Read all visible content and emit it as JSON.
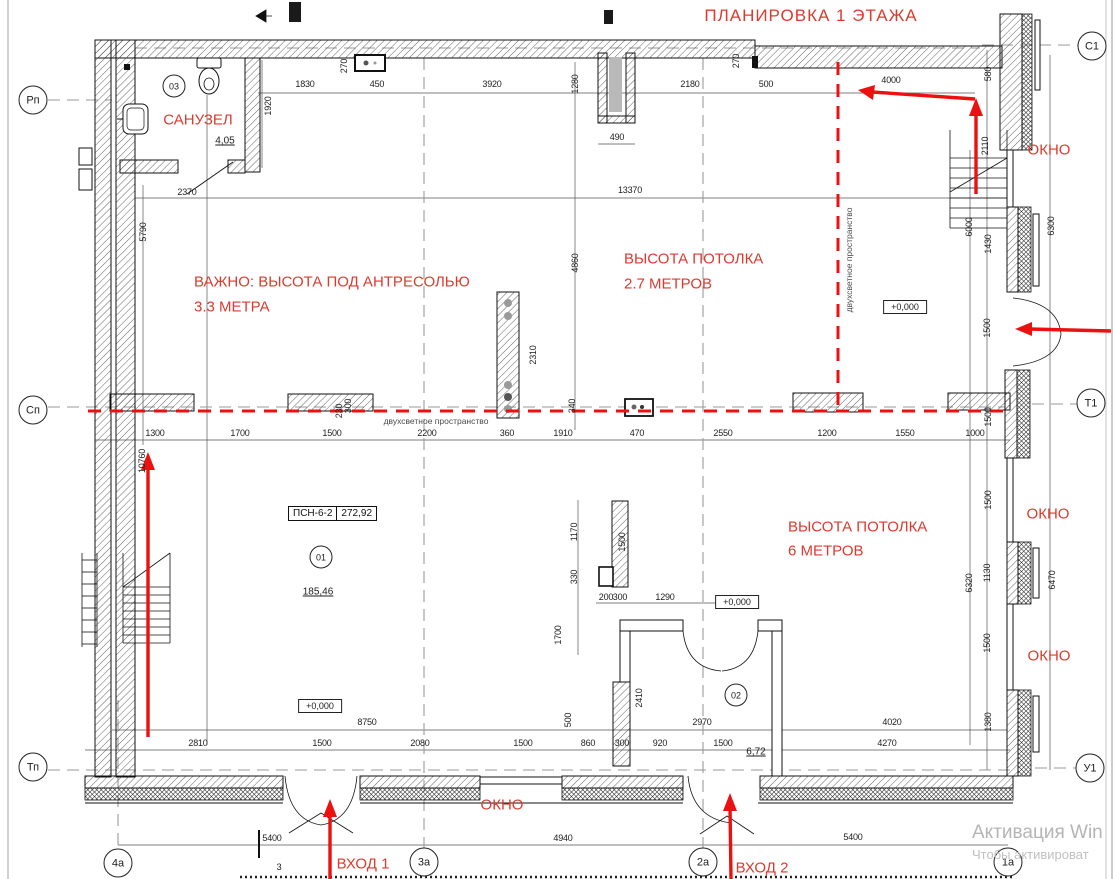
{
  "title": "ПЛАНИРОВКА 1 ЭТАЖА",
  "colors": {
    "annotation_red": "#dd3a2e",
    "arrow_red": "#ec1010",
    "drawing_black": "#111111",
    "axis_gray": "#9a9a9a",
    "watermark_gray": "#b5b5b5"
  },
  "axis_markers": [
    {
      "text": "Рп",
      "x": 33,
      "y": 100
    },
    {
      "text": "Сп",
      "x": 33,
      "y": 410
    },
    {
      "text": "Тп",
      "x": 33,
      "y": 767
    },
    {
      "text": "С1",
      "x": 1092,
      "y": 46
    },
    {
      "text": "Т1",
      "x": 1091,
      "y": 403
    },
    {
      "text": "У1",
      "x": 1090,
      "y": 768
    },
    {
      "text": "4а",
      "x": 118,
      "y": 863
    },
    {
      "text": "3а",
      "x": 424,
      "y": 862
    },
    {
      "text": "2а",
      "x": 703,
      "y": 862
    },
    {
      "text": "1а",
      "x": 1008,
      "y": 862
    }
  ],
  "red_annotations": [
    {
      "text": "САНУЗЕЛ",
      "x": 198,
      "y": 120
    },
    {
      "text": "ВАЖНО: ВЫСОТА ПОД АНТРЕСОЛЬЮ",
      "x": 194,
      "y": 282,
      "anchor": "left"
    },
    {
      "text": "3.3 МЕТРА",
      "x": 194,
      "y": 307,
      "anchor": "left"
    },
    {
      "text": "ВЫСОТА ПОТОЛКА",
      "x": 624,
      "y": 259,
      "anchor": "left"
    },
    {
      "text": "2.7 МЕТРОВ",
      "x": 624,
      "y": 284,
      "anchor": "left"
    },
    {
      "text": "ВЫСОТА ПОТОЛКА",
      "x": 788,
      "y": 527,
      "anchor": "left"
    },
    {
      "text": "6 МЕТРОВ",
      "x": 788,
      "y": 551,
      "anchor": "left"
    },
    {
      "text": "ОКНО",
      "x": 1049,
      "y": 150
    },
    {
      "text": "ОКНО",
      "x": 1048,
      "y": 514
    },
    {
      "text": "ОКНО",
      "x": 1049,
      "y": 656
    },
    {
      "text": "ОКНО",
      "x": 502,
      "y": 805
    },
    {
      "text": "ВХОД 1",
      "x": 363,
      "y": 864
    },
    {
      "text": "ВХОД 2",
      "x": 762,
      "y": 868
    }
  ],
  "dimensions": [
    {
      "text": "1830",
      "x": 305,
      "y": 84
    },
    {
      "text": "450",
      "x": 377,
      "y": 84
    },
    {
      "text": "270",
      "x": 344,
      "y": 66,
      "rot": true
    },
    {
      "text": "3920",
      "x": 492,
      "y": 84
    },
    {
      "text": "1280",
      "x": 575,
      "y": 84,
      "rot": true
    },
    {
      "text": "2180",
      "x": 690,
      "y": 84
    },
    {
      "text": "500",
      "x": 766,
      "y": 84
    },
    {
      "text": "270",
      "x": 736,
      "y": 61,
      "rot": true
    },
    {
      "text": "4000",
      "x": 891,
      "y": 80
    },
    {
      "text": "580",
      "x": 988,
      "y": 74,
      "rot": true
    },
    {
      "text": "1920",
      "x": 268,
      "y": 106,
      "rot": true
    },
    {
      "text": "490",
      "x": 617,
      "y": 137
    },
    {
      "text": "2370",
      "x": 187,
      "y": 192
    },
    {
      "text": "13370",
      "x": 630,
      "y": 190
    },
    {
      "text": "5790",
      "x": 143,
      "y": 232,
      "rot": true
    },
    {
      "text": "4860",
      "x": 575,
      "y": 263,
      "rot": true
    },
    {
      "text": "2310",
      "x": 533,
      "y": 355,
      "rot": true
    },
    {
      "text": "340",
      "x": 572,
      "y": 406,
      "rot": true
    },
    {
      "text": "2110",
      "x": 985,
      "y": 146,
      "rot": true
    },
    {
      "text": "6000",
      "x": 969,
      "y": 227,
      "rot": true
    },
    {
      "text": "1430",
      "x": 988,
      "y": 244,
      "rot": true
    },
    {
      "text": "6300",
      "x": 1051,
      "y": 226,
      "rot": true
    },
    {
      "text": "1500",
      "x": 987,
      "y": 328,
      "rot": true
    },
    {
      "text": "1300",
      "x": 155,
      "y": 433
    },
    {
      "text": "1700",
      "x": 240,
      "y": 433
    },
    {
      "text": "1500",
      "x": 332,
      "y": 433
    },
    {
      "text": "2200",
      "x": 427,
      "y": 433
    },
    {
      "text": "360",
      "x": 507,
      "y": 433
    },
    {
      "text": "1910",
      "x": 563,
      "y": 433
    },
    {
      "text": "470",
      "x": 637,
      "y": 433
    },
    {
      "text": "2550",
      "x": 723,
      "y": 433
    },
    {
      "text": "1200",
      "x": 827,
      "y": 433
    },
    {
      "text": "1550",
      "x": 905,
      "y": 433
    },
    {
      "text": "1000",
      "x": 975,
      "y": 433
    },
    {
      "text": "230",
      "x": 339,
      "y": 411,
      "rot": true
    },
    {
      "text": "300",
      "x": 348,
      "y": 406,
      "rot": true
    },
    {
      "text": "10760",
      "x": 142,
      "y": 461,
      "rot": true
    },
    {
      "text": "1500",
      "x": 988,
      "y": 417,
      "rot": true
    },
    {
      "text": "1500",
      "x": 988,
      "y": 500,
      "rot": true
    },
    {
      "text": "1130",
      "x": 987,
      "y": 573,
      "rot": true
    },
    {
      "text": "6320",
      "x": 969,
      "y": 583,
      "rot": true
    },
    {
      "text": "6470",
      "x": 1052,
      "y": 580,
      "rot": true
    },
    {
      "text": "1500",
      "x": 987,
      "y": 643,
      "rot": true
    },
    {
      "text": "1380",
      "x": 988,
      "y": 722,
      "rot": true
    },
    {
      "text": "1170",
      "x": 574,
      "y": 532,
      "rot": true
    },
    {
      "text": "1500",
      "x": 622,
      "y": 542,
      "rot": true
    },
    {
      "text": "330",
      "x": 574,
      "y": 577,
      "rot": true
    },
    {
      "text": "200",
      "x": 606,
      "y": 597
    },
    {
      "text": "300",
      "x": 620,
      "y": 597
    },
    {
      "text": "1290",
      "x": 665,
      "y": 597
    },
    {
      "text": "1700",
      "x": 558,
      "y": 635,
      "rot": true
    },
    {
      "text": "2410",
      "x": 639,
      "y": 698,
      "rot": true
    },
    {
      "text": "500",
      "x": 568,
      "y": 720,
      "rot": true
    },
    {
      "text": "8750",
      "x": 367,
      "y": 722
    },
    {
      "text": "2970",
      "x": 702,
      "y": 722
    },
    {
      "text": "4020",
      "x": 892,
      "y": 722
    },
    {
      "text": "2810",
      "x": 198,
      "y": 743
    },
    {
      "text": "1500",
      "x": 322,
      "y": 743
    },
    {
      "text": "2080",
      "x": 420,
      "y": 743
    },
    {
      "text": "1500",
      "x": 523,
      "y": 743
    },
    {
      "text": "860",
      "x": 588,
      "y": 743
    },
    {
      "text": "300",
      "x": 622,
      "y": 743
    },
    {
      "text": "920",
      "x": 660,
      "y": 743
    },
    {
      "text": "1500",
      "x": 723,
      "y": 743
    },
    {
      "text": "4270",
      "x": 887,
      "y": 743
    },
    {
      "text": "5400",
      "x": 272,
      "y": 838
    },
    {
      "text": "4940",
      "x": 563,
      "y": 838
    },
    {
      "text": "5400",
      "x": 853,
      "y": 837
    },
    {
      "text": "3",
      "x": 279,
      "y": 867
    }
  ],
  "room_tags": [
    {
      "text": "03",
      "x": 174,
      "y": 86
    },
    {
      "text": "01",
      "x": 321,
      "y": 557
    },
    {
      "text": "02",
      "x": 736,
      "y": 695
    }
  ],
  "areas": [
    {
      "text": "4,05",
      "x": 225,
      "y": 141
    },
    {
      "text": "185,46",
      "x": 318,
      "y": 592
    },
    {
      "text": "6,72",
      "x": 756,
      "y": 752
    }
  ],
  "level_marks": [
    {
      "text": "+0,000",
      "x": 905,
      "y": 307
    },
    {
      "text": "+0,000",
      "x": 737,
      "y": 602
    },
    {
      "text": "+0,000",
      "x": 320,
      "y": 706
    }
  ],
  "notes": [
    {
      "text": "двухсветное пространство",
      "x": 849,
      "y": 260,
      "rot": true
    },
    {
      "text": "двухсветное пространство",
      "x": 436,
      "y": 421
    }
  ],
  "stamp": {
    "name": "ПСН-6-2",
    "area": "272,92"
  },
  "watermark": {
    "line1": "Активация Win",
    "line2": "Чтобы активироват"
  }
}
